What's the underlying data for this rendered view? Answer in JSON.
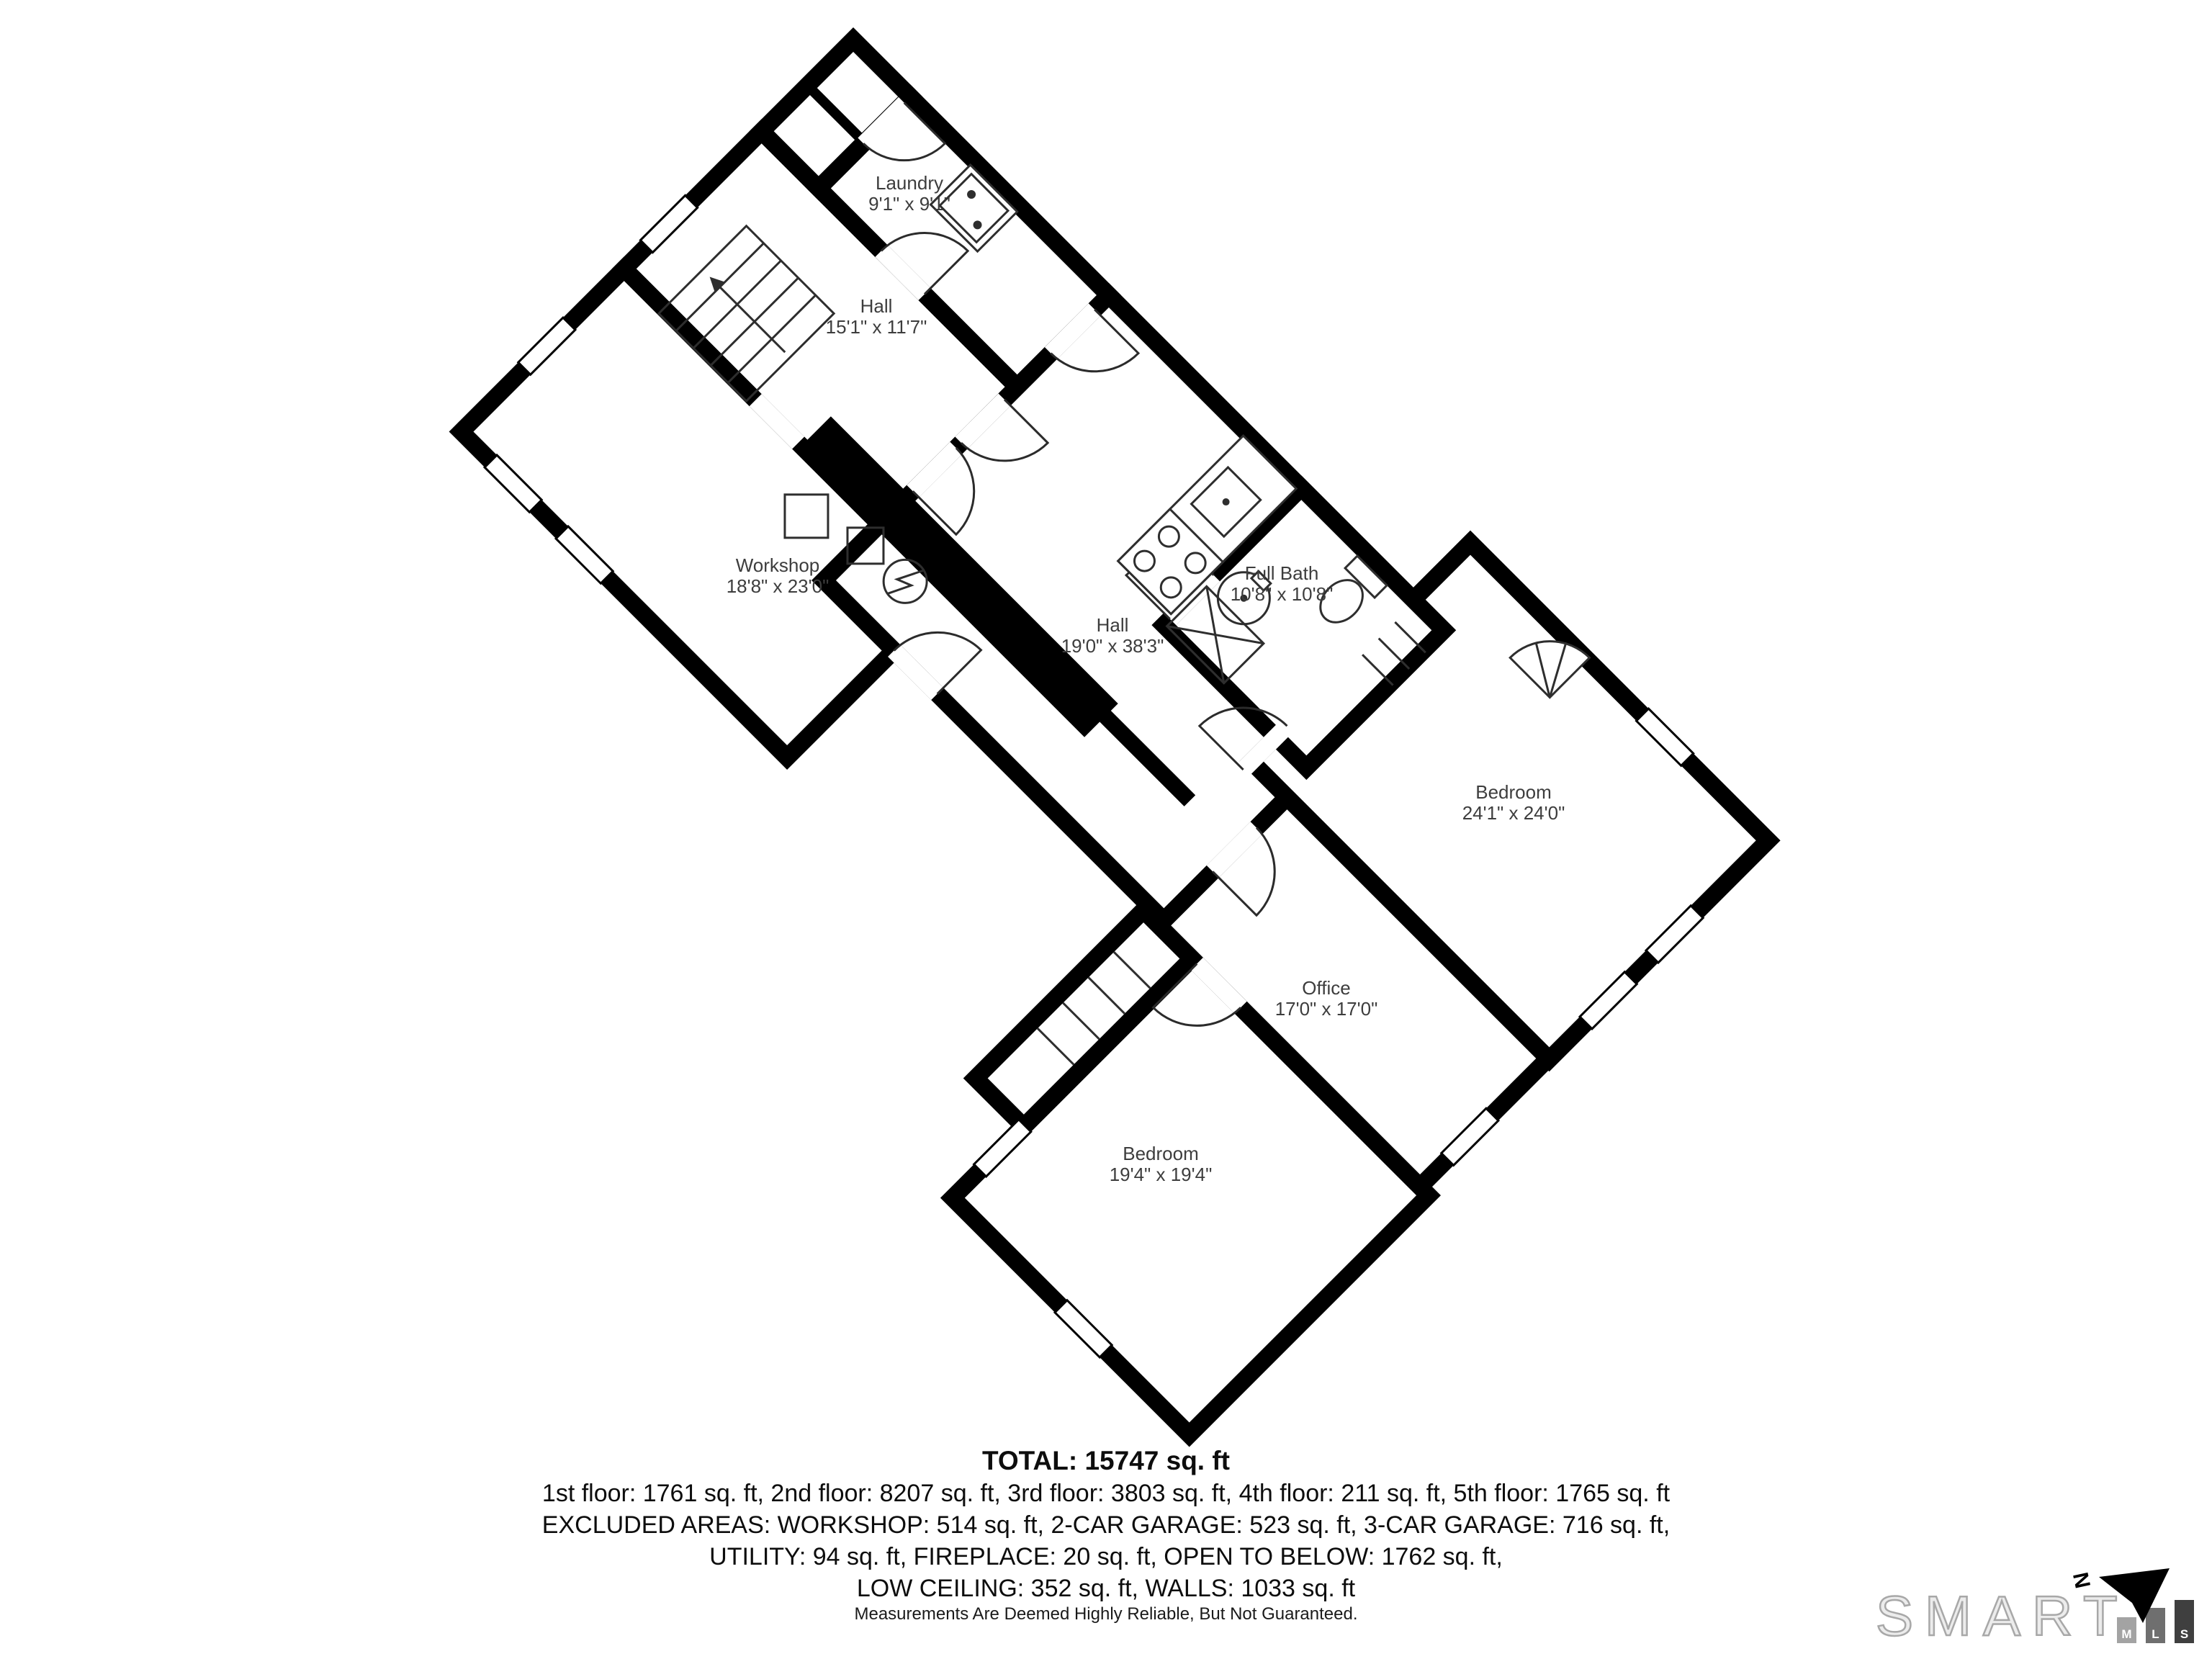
{
  "floor_plan": {
    "rooms": [
      {
        "name": "Laundry",
        "dimensions": "9'1\" x 9'1\""
      },
      {
        "name": "Hall",
        "dimensions": "15'1\" x 11'7\""
      },
      {
        "name": "Workshop",
        "dimensions": "18'8\" x 23'0\""
      },
      {
        "name": "Hall",
        "dimensions": "19'0\" x 38'3\""
      },
      {
        "name": "Full Bath",
        "dimensions": "10'8\" x 10'8\""
      },
      {
        "name": "Bedroom",
        "dimensions": "24'1\" x 24'0\""
      },
      {
        "name": "Office",
        "dimensions": "17'0\" x 17'0\""
      },
      {
        "name": "Bedroom",
        "dimensions": "19'4\" x 19'4\""
      }
    ]
  },
  "summary": {
    "total": "TOTAL: 15747 sq. ft",
    "floors": "1st floor: 1761 sq. ft, 2nd floor: 8207 sq. ft, 3rd floor: 3803 sq. ft, 4th floor: 211 sq. ft, 5th floor: 1765 sq. ft",
    "excluded_line1": "EXCLUDED AREAS: WORKSHOP: 514 sq. ft, 2-CAR GARAGE: 523 sq. ft, 3-CAR GARAGE: 716 sq. ft,",
    "excluded_line2": "UTILITY: 94 sq. ft, FIREPLACE: 20 sq. ft, OPEN TO BELOW: 1762 sq. ft,",
    "excluded_line3": "LOW CEILING: 352 sq. ft, WALLS: 1033 sq. ft"
  },
  "footer": {
    "disclaimer": "Measurements Are Deemed Highly Reliable, But Not Guaranteed.",
    "logo": {
      "brand": "SMART",
      "letters": [
        "M",
        "L",
        "S"
      ],
      "north_label": "N"
    }
  },
  "colors": {
    "walls": "#000000",
    "background": "#ffffff",
    "label_text": "#3d3d3d",
    "logo_gray": "#a8a8a8",
    "bar_m": "#a3a3a3",
    "bar_l": "#6f6f6f",
    "bar_s": "#3f3f3f"
  }
}
